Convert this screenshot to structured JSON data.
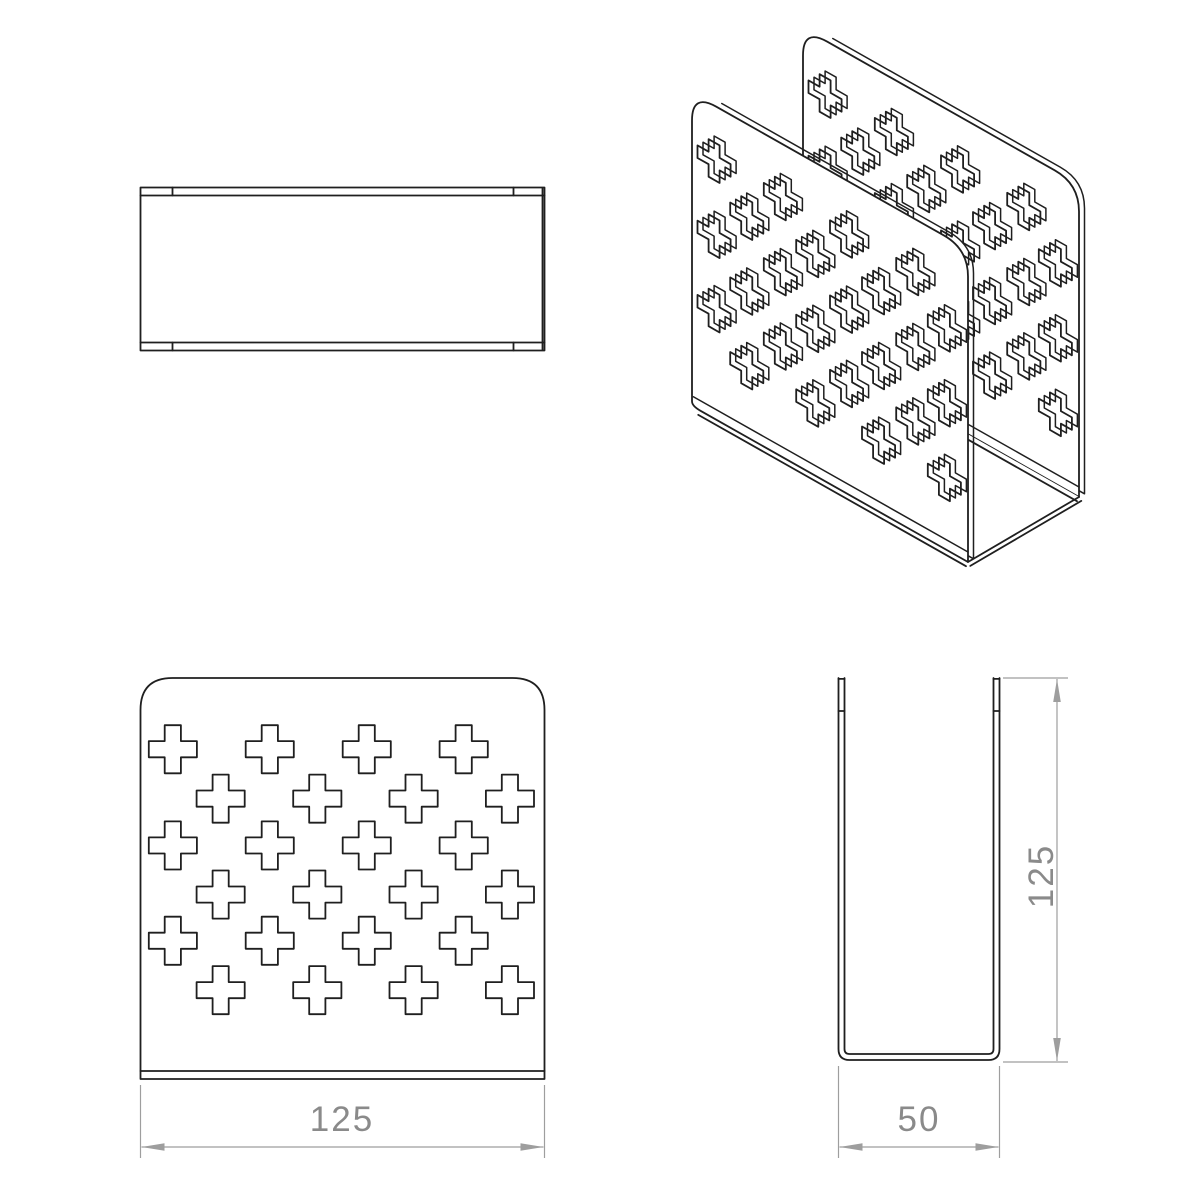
{
  "meta": {
    "background": "#ffffff",
    "ink_color": "#1f1f1f",
    "dim_color": "#9e9e9e",
    "dim_text_color": "#8a8a8a"
  },
  "part": {
    "width_mm": 125,
    "height_mm": 125,
    "depth_mm": 50,
    "thickness_mm": 2.5,
    "corner_radius_mm": 10,
    "hole_pattern": {
      "cross_size_mm": 15,
      "cross_arm_mm": 5,
      "rows": [
        {
          "y_mm": 22.2,
          "x_mm": [
            10,
            40,
            70,
            100
          ]
        },
        {
          "y_mm": 37.6,
          "x_mm": [
            24.8,
            54.7,
            84.5,
            114.3
          ]
        },
        {
          "y_mm": 52.2,
          "x_mm": [
            10,
            40,
            70,
            100
          ]
        },
        {
          "y_mm": 67.5,
          "x_mm": [
            24.8,
            54.7,
            84.5,
            114.3
          ]
        },
        {
          "y_mm": 81.9,
          "x_mm": [
            10,
            40,
            70,
            100
          ]
        },
        {
          "y_mm": 97.3,
          "x_mm": [
            24.8,
            54.7,
            84.5,
            114.3
          ]
        }
      ]
    }
  },
  "views": {
    "top": {
      "x": 140.5,
      "y": 187.5,
      "w": 404,
      "h": 163,
      "band": 8,
      "tick_xs": [
        172.5,
        513.5
      ],
      "inner_right": 542.5
    },
    "front": {
      "x": 140.5,
      "y": 678,
      "w": 404,
      "h": 401,
      "corner_r": 32,
      "bend_offset": 8,
      "dim": {
        "label": "125",
        "line_y": 1147,
        "ext_y1": 1085,
        "ext_y2": 1158,
        "arrow_len": 23,
        "arrow_hw": 3.8
      }
    },
    "side": {
      "left": 838.5,
      "right": 999.5,
      "top": 678,
      "bottom": 1060,
      "wall_t": 6,
      "r_out": 11,
      "r_in": 5,
      "tick_y": 711,
      "dim_w": {
        "label": "50",
        "line_y": 1147,
        "ext_y1": 1066,
        "ext_y2": 1158,
        "arrow_len": 23,
        "arrow_hw": 3.8
      },
      "dim_h": {
        "label": "125",
        "line_x": 1057,
        "ext_x1": 1003,
        "ext_x2": 1068,
        "arrow_len": 23,
        "arrow_hw": 3.8
      }
    },
    "iso": {
      "near_wall": {
        "tl": [
          692,
          93
        ],
        "tr": [
          968,
          249
        ],
        "bl": [
          692,
          406
        ],
        "br": [
          968,
          562
        ]
      },
      "far_wall": {
        "tl": [
          803,
          28
        ],
        "tr": [
          1079,
          184
        ],
        "bl": [
          803,
          341
        ],
        "br": [
          1079,
          497
        ]
      },
      "thickness_offset": [
        5.5,
        -3.2
      ],
      "bottom_edge_offset": [
        -2,
        4.2
      ],
      "w_edge_offset": [
        2.3,
        3.9
      ],
      "corner_r_frac": 0.088,
      "bend_v": 0.968,
      "bottom_corner_u": 0.03
    }
  }
}
